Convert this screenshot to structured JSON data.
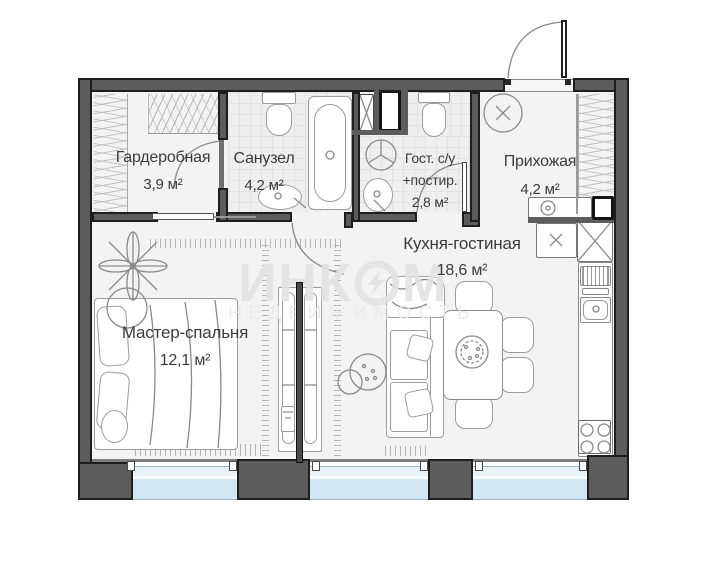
{
  "plan_title": "floor-plan",
  "rooms": {
    "wardrobe": {
      "name": "Гардеробная",
      "area": "3,9 м²"
    },
    "bathroom": {
      "name": "Санузел",
      "area": "4,2 м²"
    },
    "guest_wc": {
      "name": "Гост. с/у",
      "name2": "+постир.",
      "area": "2,8 м²"
    },
    "hallway": {
      "name": "Прихожая",
      "area": "4,2 м²"
    },
    "kitchen_living": {
      "name": "Кухня-гостиная",
      "area": "18,6 м²"
    },
    "master_bedroom": {
      "name": "Мастер-спальня",
      "area": "12,1 м²"
    }
  },
  "watermark": {
    "brand_prefix": "ИНК",
    "brand_suffix": "М",
    "tagline": "НЕДВИЖИМОСТЬ"
  },
  "icons": [
    "entrance-door-icon",
    "door-arc-icon",
    "bathtub-icon",
    "toilet-icon",
    "sink-icon",
    "shower-icon",
    "washing-machine-icon",
    "vent-shaft-icon",
    "dishwasher-icon",
    "kitchen-sink-icon",
    "stove-icon",
    "dining-table-icon",
    "chair-icon",
    "sofa-icon",
    "bed-icon",
    "plant-icon",
    "wardrobe-rail-icon",
    "peephole-cross-icon"
  ],
  "colors": {
    "wall": "#5c5c5c",
    "outline": "#1e1e1e",
    "window_glass": "#d7e9f4",
    "floor": "#f3f3f3",
    "tile": "#efefef",
    "watermark": "#e3e3e3",
    "label_text": "#3b3b3b"
  }
}
